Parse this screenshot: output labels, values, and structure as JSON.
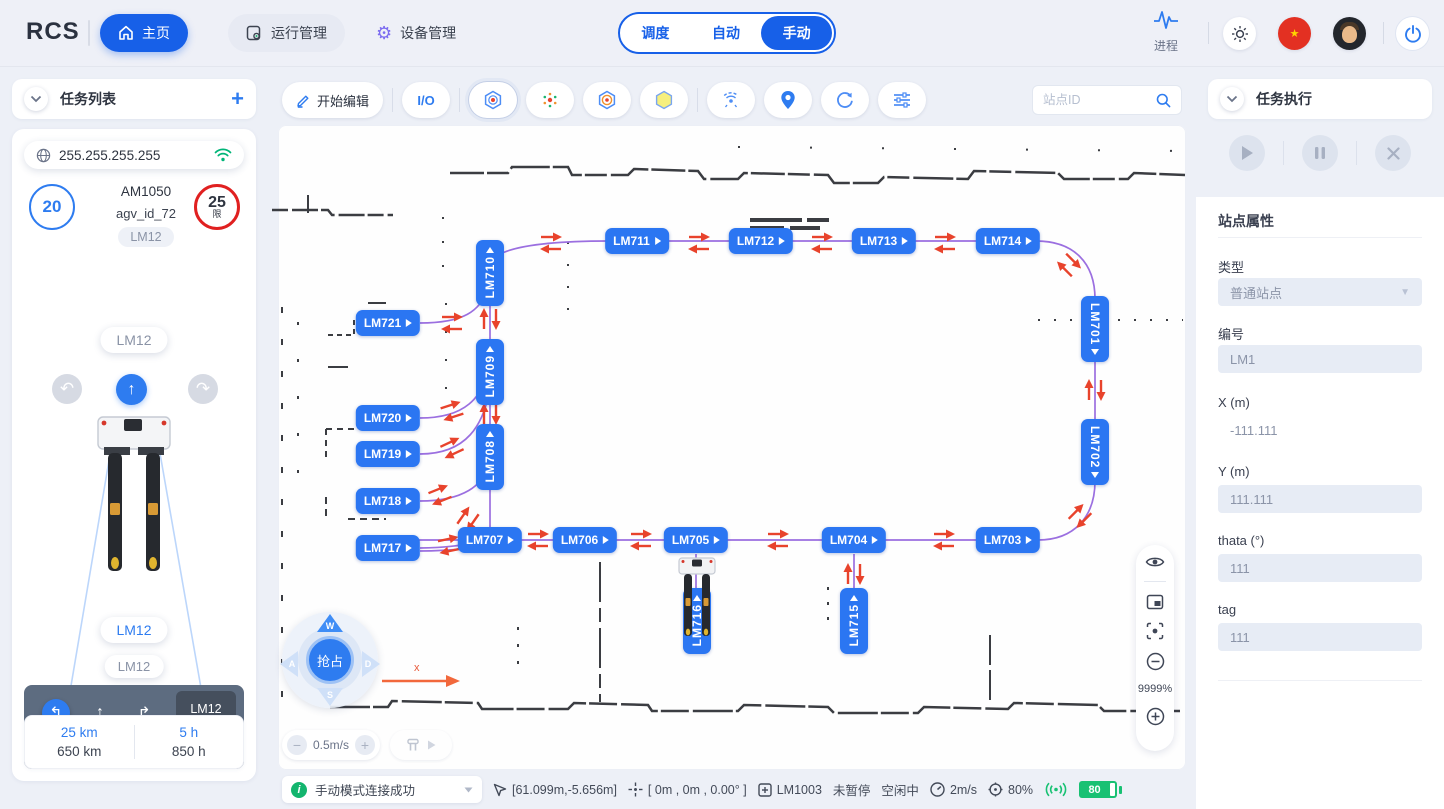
{
  "navbar": {
    "logo": "RCS",
    "nav_items": [
      {
        "label": "主页"
      },
      {
        "label": "运行管理"
      },
      {
        "label": "设备管理"
      }
    ],
    "mode_tabs": [
      {
        "label": "调度"
      },
      {
        "label": "自动"
      },
      {
        "label": "手动"
      }
    ],
    "active_mode": "手动",
    "process_label": "进程"
  },
  "left_panel": {
    "header": "任务列表",
    "ip": "255.255.255.255",
    "speed_value": "20",
    "limit_value": "25",
    "limit_suffix": "限",
    "model": "AM1050",
    "agv_id": "agv_id_72",
    "pill_top": "LM12",
    "pill_second": "LM12",
    "pill_current": "LM12",
    "pill_next": "LM12",
    "nav_card": {
      "from": "LM12",
      "arrow": "↑",
      "to": "LM11",
      "instruction": "在 LM2 左转"
    },
    "stats": {
      "trip_km": "25 km",
      "total_km": "650 km",
      "trip_h": "5 h",
      "total_h": "850 h"
    }
  },
  "map": {
    "toolbar": {
      "edit": "开始编辑",
      "io": "I/O",
      "search_placeholder": "站点ID"
    },
    "zoom_level": "9999%",
    "joystick": {
      "up": "W",
      "left": "A",
      "down": "S",
      "right": "D",
      "center": "抢占"
    },
    "speed_step": "0.5m/s",
    "axis_label": "x",
    "stations": [
      {
        "id": "LM710",
        "x": 222,
        "y": 206,
        "o": "v",
        "p": "up"
      },
      {
        "id": "LM711",
        "x": 369,
        "y": 174,
        "o": "h"
      },
      {
        "id": "LM712",
        "x": 493,
        "y": 174,
        "o": "h"
      },
      {
        "id": "LM713",
        "x": 616,
        "y": 174,
        "o": "h"
      },
      {
        "id": "LM714",
        "x": 740,
        "y": 174,
        "o": "h"
      },
      {
        "id": "LM701",
        "x": 827,
        "y": 262,
        "o": "v",
        "p": "down"
      },
      {
        "id": "LM702",
        "x": 827,
        "y": 385,
        "o": "v",
        "p": "down"
      },
      {
        "id": "LM703",
        "x": 740,
        "y": 473,
        "o": "h"
      },
      {
        "id": "LM704",
        "x": 586,
        "y": 473,
        "o": "h"
      },
      {
        "id": "LM705",
        "x": 428,
        "y": 473,
        "o": "h"
      },
      {
        "id": "LM706",
        "x": 317,
        "y": 473,
        "o": "h"
      },
      {
        "id": "LM707",
        "x": 222,
        "y": 473,
        "o": "h"
      },
      {
        "id": "LM708",
        "x": 222,
        "y": 390,
        "o": "v",
        "p": "up"
      },
      {
        "id": "LM709",
        "x": 222,
        "y": 305,
        "o": "v",
        "p": "up"
      },
      {
        "id": "LM715",
        "x": 586,
        "y": 554,
        "o": "v",
        "p": "up"
      },
      {
        "id": "LM716",
        "x": 429,
        "y": 554,
        "o": "v",
        "p": "up"
      },
      {
        "id": "LM717",
        "x": 120,
        "y": 481,
        "o": "h"
      },
      {
        "id": "LM718",
        "x": 120,
        "y": 434,
        "o": "h"
      },
      {
        "id": "LM719",
        "x": 120,
        "y": 387,
        "o": "h"
      },
      {
        "id": "LM720",
        "x": 120,
        "y": 351,
        "o": "h"
      },
      {
        "id": "LM721",
        "x": 120,
        "y": 256,
        "o": "h"
      }
    ],
    "arrow_pairs": [
      {
        "x": 283,
        "y": 176,
        "a": 0
      },
      {
        "x": 431,
        "y": 176,
        "a": 0
      },
      {
        "x": 554,
        "y": 176,
        "a": 0
      },
      {
        "x": 677,
        "y": 176,
        "a": 0
      },
      {
        "x": 801,
        "y": 198,
        "a": 45
      },
      {
        "x": 827,
        "y": 323,
        "a": -90
      },
      {
        "x": 812,
        "y": 449,
        "a": 135
      },
      {
        "x": 676,
        "y": 473,
        "a": 0
      },
      {
        "x": 510,
        "y": 473,
        "a": 0
      },
      {
        "x": 373,
        "y": 473,
        "a": 0
      },
      {
        "x": 270,
        "y": 473,
        "a": 0
      },
      {
        "x": 181,
        "y": 478,
        "a": -12
      },
      {
        "x": 172,
        "y": 428,
        "a": -22
      },
      {
        "x": 184,
        "y": 381,
        "a": -25
      },
      {
        "x": 184,
        "y": 344,
        "a": -18
      },
      {
        "x": 200,
        "y": 452,
        "a": -55
      },
      {
        "x": 222,
        "y": 252,
        "a": -90
      },
      {
        "x": 222,
        "y": 347,
        "a": -90
      },
      {
        "x": 586,
        "y": 507,
        "a": -90
      },
      {
        "x": 184,
        "y": 256,
        "a": 0
      }
    ]
  },
  "status_bar": {
    "message": "手动模式连接成功",
    "position": "[61.099m,-5.656m]",
    "pose": "[ 0m , 0m , 0.00° ]",
    "station": "LM1003",
    "pause_state": "未暂停",
    "idle_state": "空闲中",
    "speed": "2m/s",
    "battery_pct": "80%",
    "battery_level": "80"
  },
  "right_panel": {
    "header": "任务执行",
    "props_title": "站点属性",
    "fields": {
      "type_label": "类型",
      "type_value": "普通站点",
      "code_label": "编号",
      "code_value": "LM1",
      "x_label": "X (m)",
      "x_value": "-111.111",
      "y_label": "Y (m)",
      "y_value": "111.111",
      "theta_label": "thata (°)",
      "theta_value": "111",
      "tag_label": "tag",
      "tag_value": "111"
    }
  }
}
